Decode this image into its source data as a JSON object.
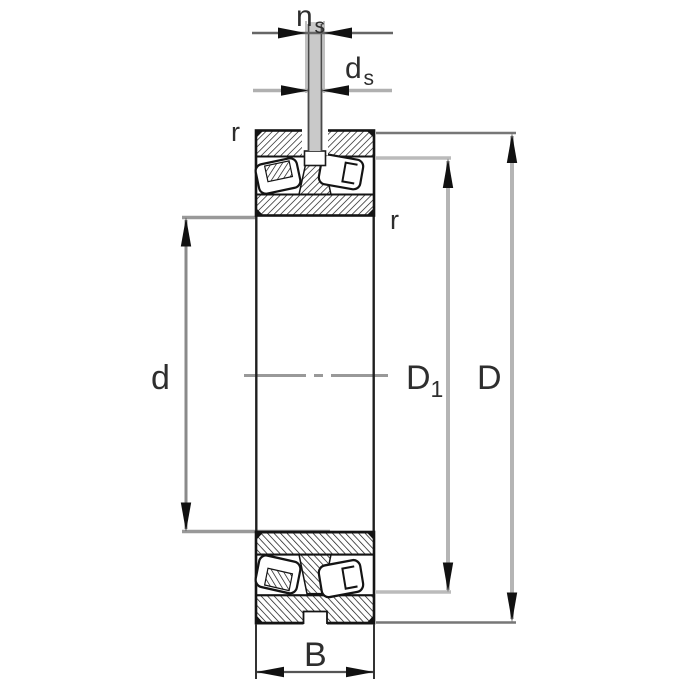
{
  "diagram": {
    "kind": "bearing-section-drawing",
    "labels": {
      "ns": {
        "main": "n",
        "sub": "s"
      },
      "ds": {
        "main": "d",
        "sub": "s"
      },
      "r_top": "r",
      "r_inner": "r",
      "d": "d",
      "D1": {
        "main": "D",
        "sub": "1"
      },
      "D": "D",
      "B": "B"
    },
    "colors": {
      "outline": "#141414",
      "dim_line": "#8a8a8a",
      "dim_line_light": "#b5b5b5",
      "ext_line": "#999999",
      "pin_fill": "#c9c9c9",
      "text": "#2e2e2e",
      "background": "#ffffff"
    }
  }
}
